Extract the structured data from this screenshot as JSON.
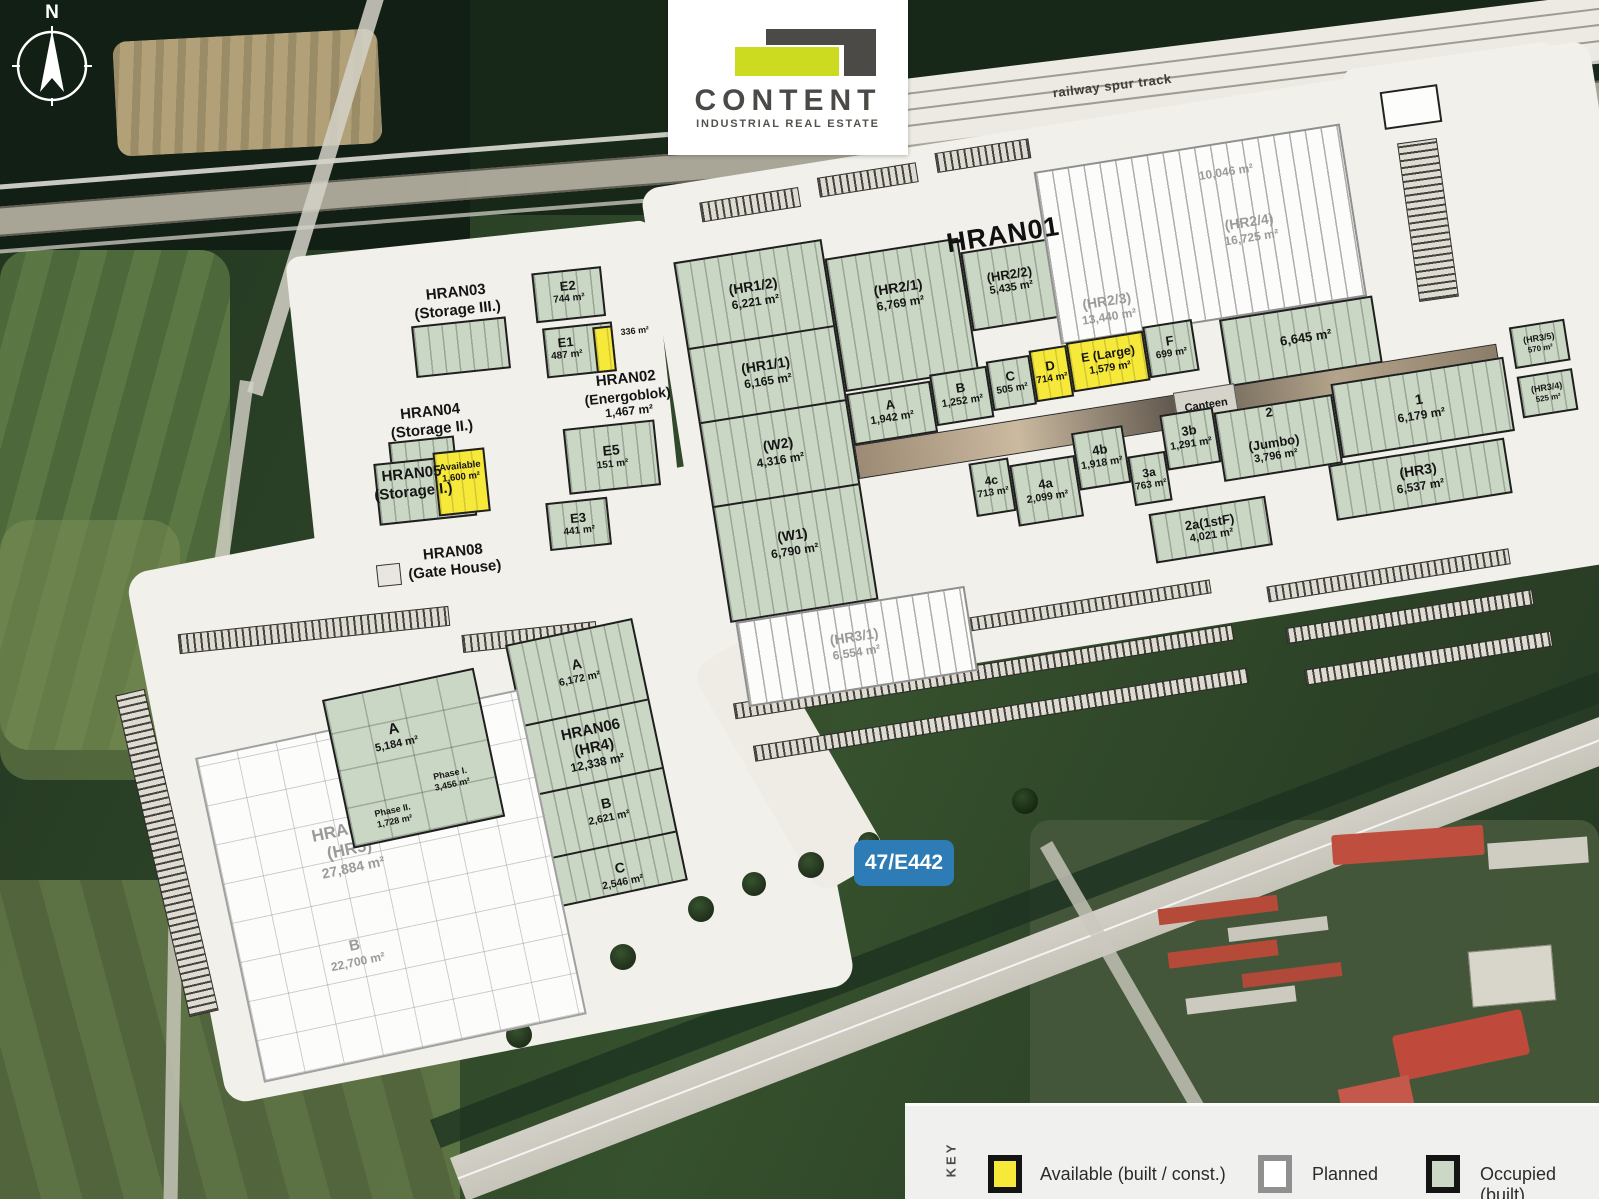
{
  "palette": {
    "occupied": "#ccd7c5",
    "planned": "#fcfcfa",
    "available": "#f7e93a",
    "pad": "#f2f0ea",
    "sign_blue": "#2d7cb5",
    "logo_dark": "#4b4a46",
    "logo_accent": "#ccda20"
  },
  "compass": {
    "north": "N"
  },
  "logo": {
    "name": "CONTENT",
    "tagline": "INDUSTRIAL REAL ESTATE"
  },
  "railway_note": "railway spur track",
  "road_sign": "47/E442",
  "legend": {
    "title": "KEY",
    "items": [
      {
        "label": "Available (built / const.)",
        "color": "#f7e93a",
        "border": "#141414"
      },
      {
        "label": "Planned",
        "color": "#ffffff",
        "border": "#909090"
      },
      {
        "label": "Occupied (built)",
        "color": "#ccd7c5",
        "border": "#141414"
      }
    ]
  },
  "main": {
    "title": "HRAN01",
    "units": {
      "hr12": {
        "label": "(HR1/2)",
        "area": "6,221 m²",
        "status": "occupied"
      },
      "hr11": {
        "label": "(HR1/1)",
        "area": "6,165 m²",
        "status": "occupied"
      },
      "w2": {
        "label": "(W2)",
        "area": "4,316 m²",
        "status": "occupied"
      },
      "w1": {
        "label": "(W1)",
        "area": "6,790 m²",
        "status": "occupied"
      },
      "hr21": {
        "label": "(HR2/1)",
        "area": "6,769 m²",
        "status": "occupied"
      },
      "hr22": {
        "label": "(HR2/2)",
        "area": "5,435 m²",
        "status": "occupied"
      },
      "hr23": {
        "label": "(HR2/3)",
        "area": "13,440 m²",
        "status": "planned"
      },
      "hr24": {
        "label": "(HR2/4)",
        "area": "16,725 m²",
        "status": "planned"
      },
      "n1": {
        "area": "10,046 m²",
        "status": "planned"
      },
      "g6645": {
        "area": "6,645 m²",
        "status": "occupied"
      },
      "a": {
        "label": "A",
        "area": "1,942 m²",
        "status": "occupied"
      },
      "b": {
        "label": "B",
        "area": "1,252 m²",
        "status": "occupied"
      },
      "c": {
        "label": "C",
        "area": "505 m²",
        "status": "occupied"
      },
      "d": {
        "label": "D",
        "area": "714 m²",
        "status": "available"
      },
      "e": {
        "label": "E (Large)",
        "area": "1,579 m²",
        "status": "available"
      },
      "f": {
        "label": "F",
        "area": "699 m²",
        "status": "occupied"
      },
      "canteen": {
        "label": "Canteen"
      },
      "u5a": {
        "label": "5a",
        "area": "2,066 m²",
        "status": "occupied"
      },
      "u5b": {
        "label": "5b",
        "area": "1,906 m²",
        "status": "occupied"
      },
      "u4c": {
        "label": "4c",
        "area": "713 m²",
        "status": "occupied"
      },
      "u4a": {
        "label": "4a",
        "area": "2,099 m²",
        "status": "occupied"
      },
      "u4b": {
        "label": "4b",
        "area": "1,918 m²",
        "status": "occupied"
      },
      "u3a": {
        "label": "3a",
        "area": "763 m²",
        "status": "occupied"
      },
      "u3b": {
        "label": "3b",
        "area": "1,291 m²",
        "status": "occupied"
      },
      "u2": {
        "label": "2",
        "sublabel": "(Jumbo)",
        "area": "3,796 m²",
        "status": "occupied"
      },
      "u2a": {
        "label": "2a(1stF)",
        "area": "4,021 m²",
        "status": "occupied"
      },
      "u1": {
        "label": "1",
        "area": "6,179 m²",
        "status": "occupied"
      },
      "hr3": {
        "label": "(HR3)",
        "area": "6,537 m²",
        "status": "occupied"
      },
      "hr31": {
        "label": "(HR3/1)",
        "area": "6,554 m²",
        "status": "planned"
      },
      "hr35": {
        "label": "(HR3/5)",
        "area": "570 m²",
        "status": "occupied"
      },
      "hr34": {
        "label": "(HR3/4)",
        "area": "525 m²",
        "status": "occupied"
      }
    }
  },
  "west": {
    "hran03": {
      "name": "HRAN03",
      "type": "(Storage III.)"
    },
    "hran02": {
      "name": "HRAN02",
      "type": "(Energoblok)",
      "area": "1,467 m²"
    },
    "hran04": {
      "name": "HRAN04",
      "type": "(Storage II.)"
    },
    "hran05": {
      "name": "HRAN05",
      "type": "(Storage I.)"
    },
    "hran05_available": {
      "label": "Available",
      "area": "1,600 m²",
      "status": "available"
    },
    "hran08": {
      "name": "HRAN08",
      "type": "(Gate House)"
    },
    "e2": {
      "label": "E2",
      "area": "744 m²",
      "status": "occupied"
    },
    "e1": {
      "label": "E1",
      "area": "487 m²",
      "status": "occupied"
    },
    "e1_available": {
      "area": "336 m²",
      "status": "available"
    },
    "e5": {
      "label": "E5",
      "area": "151 m²",
      "status": "occupied"
    },
    "e3": {
      "label": "E3",
      "area": "441 m²",
      "status": "occupied"
    }
  },
  "south": {
    "hran06": {
      "name": "HRAN06",
      "type": "(HR4)",
      "area": "12,338 m²",
      "units": {
        "a": {
          "label": "A",
          "area": "6,172 m²",
          "status": "occupied"
        },
        "b": {
          "label": "B",
          "area": "2,621 m²",
          "status": "occupied"
        },
        "c": {
          "label": "C",
          "area": "2,546 m²",
          "status": "occupied"
        }
      }
    },
    "hran07": {
      "name": "HRAN07",
      "type": "(HR5)",
      "area": "27,884 m²",
      "units": {
        "a": {
          "label": "A",
          "area": "5,184 m²",
          "status": "occupied",
          "phase1_label": "Phase I.",
          "phase1_area": "3,456 m²",
          "phase2_label": "Phase II.",
          "phase2_area": "1,728 m²"
        },
        "b": {
          "label": "B",
          "area": "22,700 m²",
          "status": "planned"
        }
      }
    }
  }
}
